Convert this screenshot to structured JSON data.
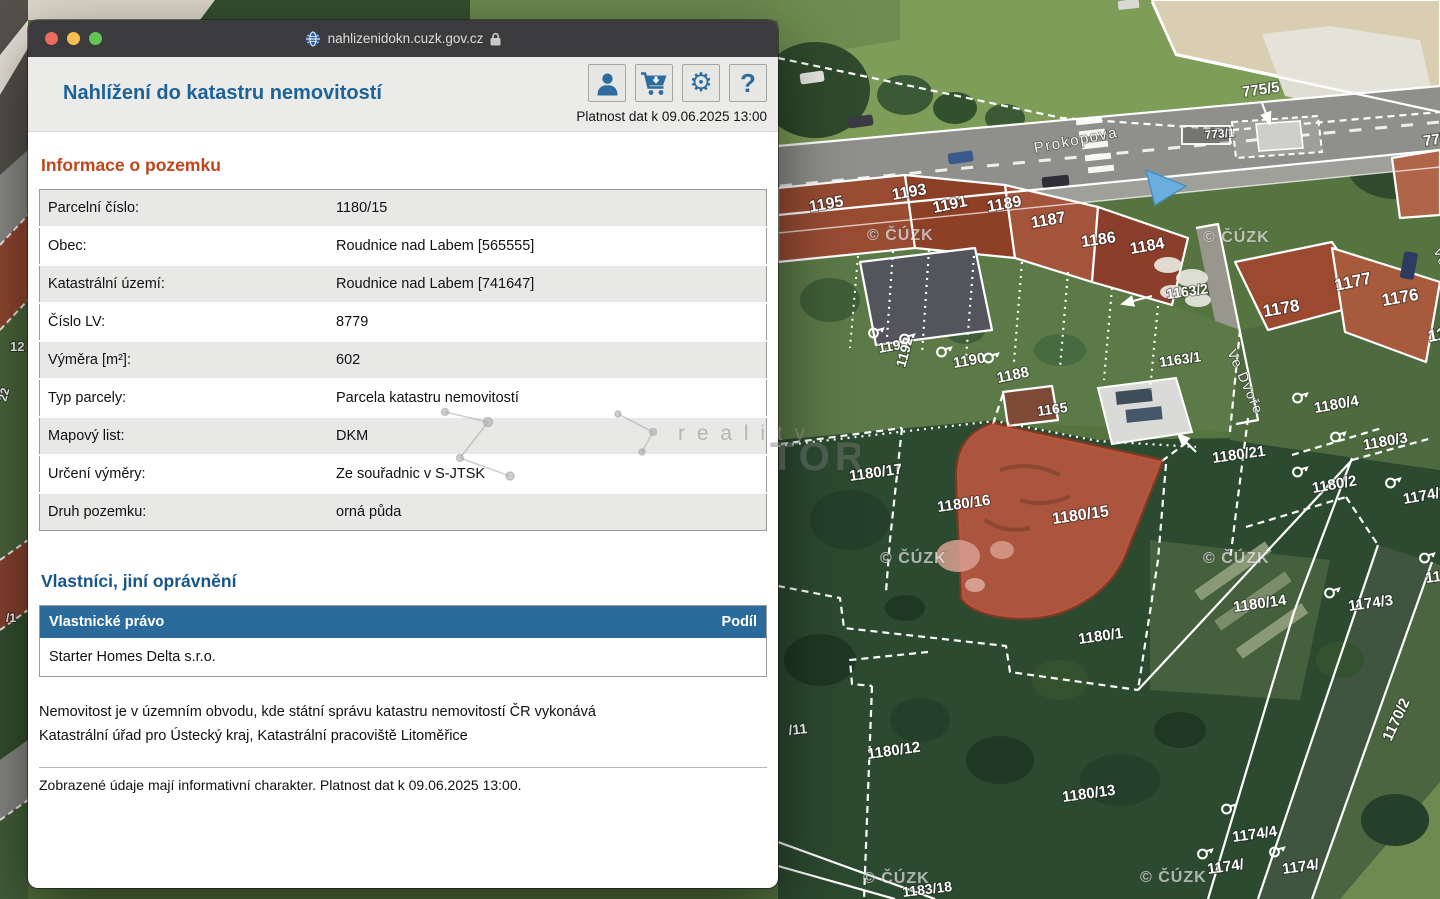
{
  "window": {
    "titlebar": {
      "url": "nahlizenidokn.cuzk.gov.cz"
    },
    "header": {
      "title": "Nahlížení do katastru nemovitostí",
      "validity": "Platnost dat k 09.06.2025 13:00"
    },
    "info": {
      "heading": "Informace o pozemku",
      "rows": [
        {
          "label": "Parcelní číslo:",
          "value": "1180/15"
        },
        {
          "label": "Obec:",
          "value": "Roudnice nad Labem [565555]"
        },
        {
          "label": "Katastrální území:",
          "value": "Roudnice nad Labem [741647]"
        },
        {
          "label": "Číslo LV:",
          "value": "8779"
        },
        {
          "label": "Výměra [m²]:",
          "value": "602"
        },
        {
          "label": "Typ parcely:",
          "value": "Parcela katastru nemovitostí"
        },
        {
          "label": "Mapový list:",
          "value": "DKM"
        },
        {
          "label": "Určení výměry:",
          "value": "Ze souřadnic v S-JTSK"
        },
        {
          "label": "Druh pozemku:",
          "value": "orná půda"
        }
      ]
    },
    "owners": {
      "heading": "Vlastníci, jiní oprávnění",
      "col_right": "Vlastnické právo",
      "col_share": "Podíl",
      "rows": [
        {
          "name": "Starter Homes Delta s.r.o.",
          "share": ""
        }
      ],
      "note": "Nemovitost je v územním obvodu, kde státní správu katastru nemovitostí ČR vykonává\nKatastrální úřad pro Ústecký kraj, Katastrální pracoviště Litoměřice",
      "disclaimer": "Zobrazené údaje mají informativní charakter. Platnost dat k 09.06.2025 13:00."
    }
  },
  "map": {
    "copyright": "© ČÚZK",
    "copyright_positions": [
      [
        867,
        240
      ],
      [
        1203,
        242
      ],
      [
        880,
        563
      ],
      [
        1203,
        563
      ],
      [
        863,
        883
      ],
      [
        1140,
        882
      ]
    ],
    "watermark": {
      "small": "r e a l i t y",
      "big": "TOR"
    },
    "selected_parcel": "1180/15",
    "labels": [
      {
        "t": "775/5",
        "x": 1243,
        "y": 97,
        "r": -8,
        "s": 15
      },
      {
        "t": "773/1",
        "x": 1205,
        "y": 139,
        "r": -5,
        "s": 12
      },
      {
        "t": "775/1",
        "x": 1424,
        "y": 146,
        "r": -8,
        "s": 15
      },
      {
        "t": "Prokopova",
        "x": 1035,
        "y": 153,
        "r": -11,
        "s": 15,
        "c": "st"
      },
      {
        "t": "Ve Dvoře",
        "x": 1227,
        "y": 352,
        "r": 66,
        "s": 14,
        "c": "st"
      },
      {
        "t": "Ve Dvoře",
        "x": 1433,
        "y": 250,
        "r": 66,
        "s": 14,
        "c": "st"
      },
      {
        "t": "1195",
        "x": 810,
        "y": 212,
        "r": -10,
        "s": 16
      },
      {
        "t": "1193",
        "x": 893,
        "y": 200,
        "r": -10,
        "s": 16
      },
      {
        "t": "1191",
        "x": 934,
        "y": 213,
        "r": -12,
        "s": 16
      },
      {
        "t": "1189",
        "x": 988,
        "y": 212,
        "r": -10,
        "s": 16
      },
      {
        "t": "1187",
        "x": 1032,
        "y": 228,
        "r": -10,
        "s": 16
      },
      {
        "t": "1186",
        "x": 1082,
        "y": 247,
        "r": -8,
        "s": 16
      },
      {
        "t": "1184",
        "x": 1131,
        "y": 254,
        "r": -10,
        "s": 16
      },
      {
        "t": "1163/2",
        "x": 1167,
        "y": 299,
        "r": -8,
        "s": 14
      },
      {
        "t": "1178",
        "x": 1264,
        "y": 317,
        "r": -10,
        "s": 17
      },
      {
        "t": "1177",
        "x": 1336,
        "y": 291,
        "r": -12,
        "s": 17
      },
      {
        "t": "1176",
        "x": 1383,
        "y": 306,
        "r": -10,
        "s": 17
      },
      {
        "t": "1175",
        "x": 1429,
        "y": 342,
        "r": -10,
        "s": 17
      },
      {
        "t": "1194",
        "x": 879,
        "y": 353,
        "r": -10,
        "s": 14
      },
      {
        "t": "1192",
        "x": 905,
        "y": 368,
        "r": -75,
        "s": 14
      },
      {
        "t": "1190",
        "x": 954,
        "y": 368,
        "r": -10,
        "s": 15
      },
      {
        "t": "1188",
        "x": 998,
        "y": 383,
        "r": -12,
        "s": 15
      },
      {
        "t": "1165",
        "x": 1038,
        "y": 416,
        "r": -8,
        "s": 14
      },
      {
        "t": "1163/1",
        "x": 1160,
        "y": 367,
        "r": -8,
        "s": 14
      },
      {
        "t": "1180/21",
        "x": 1213,
        "y": 463,
        "r": -8,
        "s": 15
      },
      {
        "t": "1180/4",
        "x": 1315,
        "y": 413,
        "r": -10,
        "s": 15
      },
      {
        "t": "1180/3",
        "x": 1364,
        "y": 450,
        "r": -10,
        "s": 15
      },
      {
        "t": "1180/2",
        "x": 1313,
        "y": 493,
        "r": -10,
        "s": 15
      },
      {
        "t": "1174/2",
        "x": 1404,
        "y": 504,
        "r": -10,
        "s": 15
      },
      {
        "t": "1180/17",
        "x": 850,
        "y": 481,
        "r": -8,
        "s": 15
      },
      {
        "t": "1180/16",
        "x": 938,
        "y": 512,
        "r": -8,
        "s": 15
      },
      {
        "t": "1180/15",
        "x": 1053,
        "y": 524,
        "r": -8,
        "s": 16
      },
      {
        "t": "1180/14",
        "x": 1234,
        "y": 612,
        "r": -8,
        "s": 15
      },
      {
        "t": "1174/3",
        "x": 1349,
        "y": 611,
        "r": -8,
        "s": 15
      },
      {
        "t": "1170/2",
        "x": 1391,
        "y": 742,
        "r": -65,
        "s": 15
      },
      {
        "t": "1180/1",
        "x": 1079,
        "y": 644,
        "r": -8,
        "s": 15
      },
      {
        "t": "1180/12",
        "x": 868,
        "y": 759,
        "r": -8,
        "s": 15
      },
      {
        "t": "1180/13",
        "x": 1063,
        "y": 802,
        "r": -8,
        "s": 15
      },
      {
        "t": "1174/4",
        "x": 1233,
        "y": 842,
        "r": -8,
        "s": 15
      },
      {
        "t": "1174/",
        "x": 1208,
        "y": 874,
        "r": -8,
        "s": 15
      },
      {
        "t": "1174/",
        "x": 1283,
        "y": 874,
        "r": -8,
        "s": 15
      },
      {
        "t": "117",
        "x": 1426,
        "y": 583,
        "r": -8,
        "s": 15
      },
      {
        "t": "/11",
        "x": 789,
        "y": 735,
        "r": -6,
        "s": 14
      },
      {
        "t": "1183/18",
        "x": 903,
        "y": 897,
        "r": -7,
        "s": 14
      },
      {
        "t": "12",
        "x": 10,
        "y": 351,
        "r": 0,
        "s": 13
      },
      {
        "t": "22",
        "x": 6,
        "y": 402,
        "r": -75,
        "s": 12
      },
      {
        "t": "/1",
        "x": 6,
        "y": 622,
        "r": 0,
        "s": 12
      }
    ],
    "flags": [
      [
        876,
        332
      ],
      [
        907,
        338
      ],
      [
        944,
        351
      ],
      [
        991,
        357
      ],
      [
        1300,
        397
      ],
      [
        1338,
        436
      ],
      [
        1300,
        471
      ],
      [
        1393,
        482
      ],
      [
        1332,
        592
      ],
      [
        1229,
        808
      ],
      [
        1277,
        851
      ],
      [
        1427,
        557
      ],
      [
        1205,
        853
      ]
    ]
  }
}
